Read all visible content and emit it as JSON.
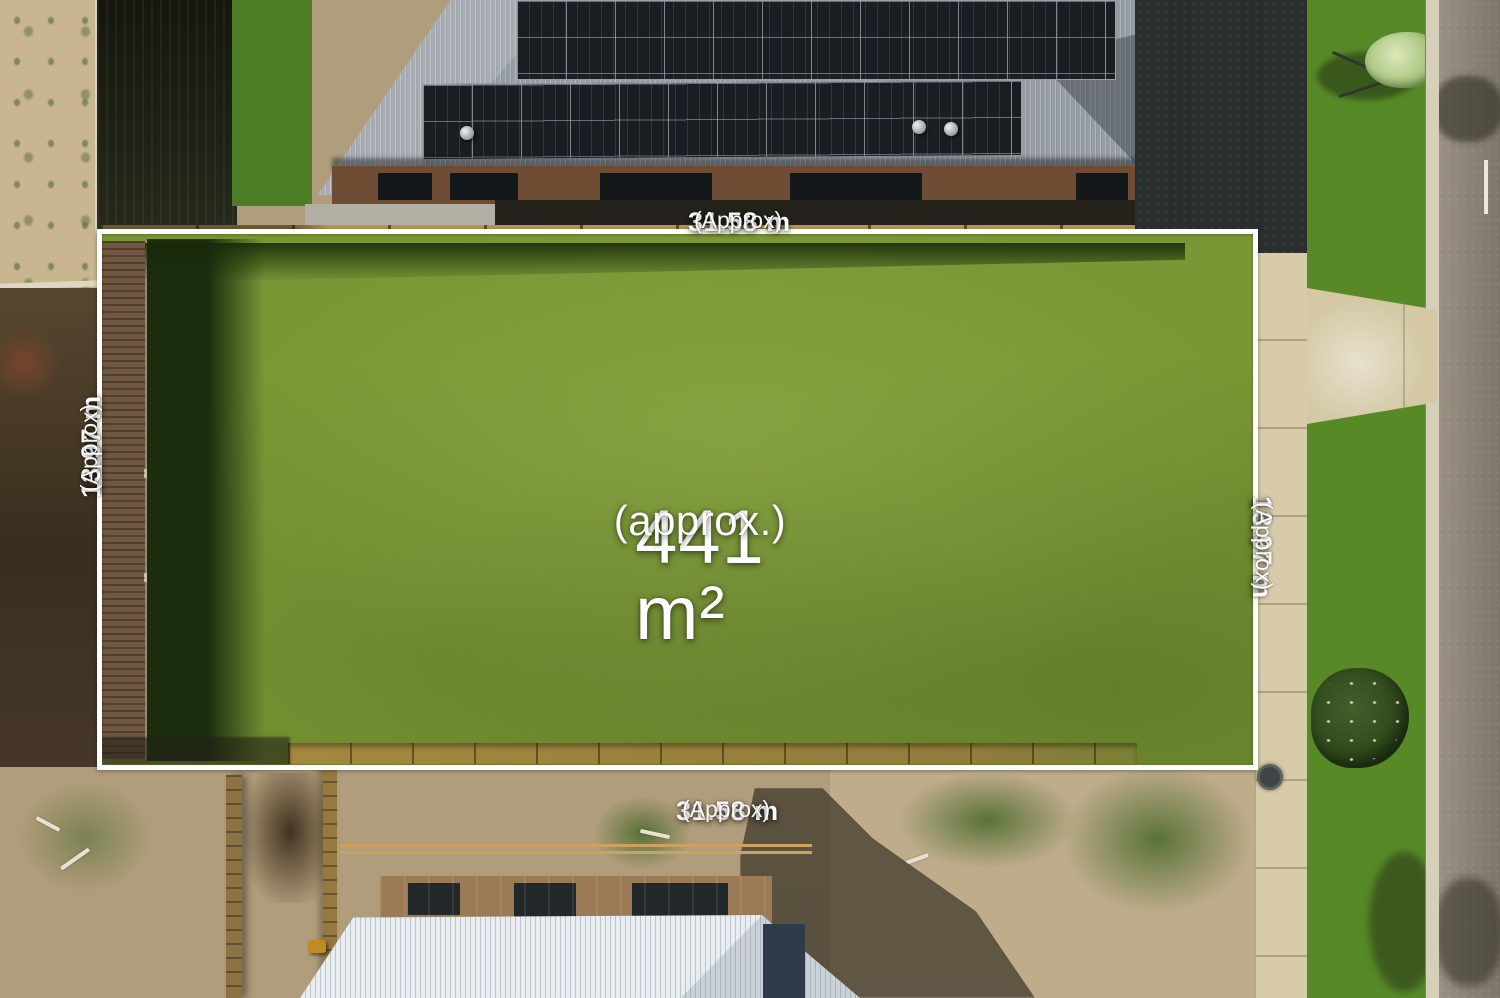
{
  "scene": {
    "type": "aerial-drone-photo",
    "subject": "Vacant residential land lot outlined in white with dimension and area overlays"
  },
  "colors": {
    "overlay_text": "#ffffff",
    "lot_outline": "#ffffff",
    "lot_grass": "#7a9735",
    "grass_shadow": "#1d2e0f",
    "top_house_roof": "#969da4",
    "solar_panels": "#1a1d21",
    "footpath_concrete": "#d7cbaa",
    "nature_strip_grass": "#578a26",
    "road_asphalt": "#8b8376",
    "dirt_ground": "#b09d7b",
    "timber_fence": "#a5883e",
    "construction_roof": "#eaedef"
  },
  "overlays": {
    "area": {
      "value": "441 m²",
      "qualifier": "(approx.)"
    },
    "frontage_top": {
      "value": "31.58 m",
      "qualifier": "(Approx)"
    },
    "frontage_bottom": {
      "value": "31.58 m",
      "qualifier": "(Approx)"
    },
    "depth_left": {
      "value": "13.97 m",
      "qualifier": "(Approx)"
    },
    "depth_right": {
      "value": "13.97 m",
      "qualifier": "(Approx)"
    }
  }
}
